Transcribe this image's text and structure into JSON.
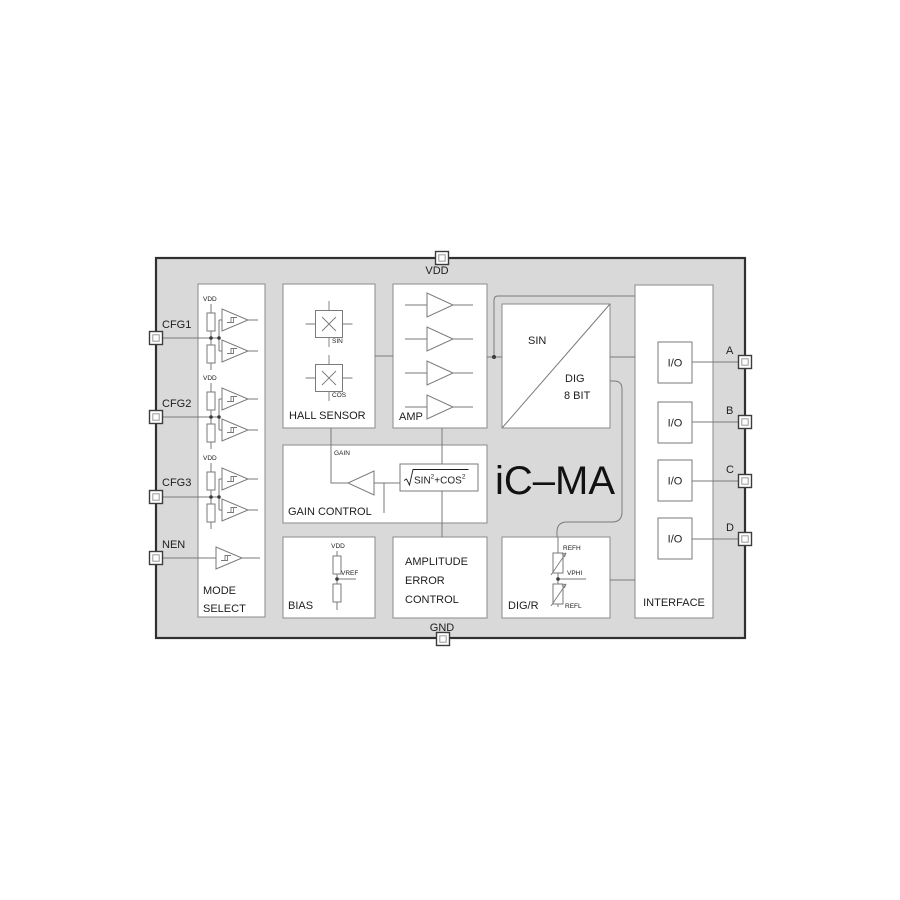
{
  "diagram": {
    "title": "iC–MA",
    "pins": {
      "top": "VDD",
      "bottom": "GND",
      "left": [
        "CFG1",
        "CFG2",
        "CFG3",
        "NEN"
      ],
      "right": [
        "A",
        "B",
        "C",
        "D"
      ]
    },
    "blocks": {
      "mode_select": {
        "label1": "MODE",
        "label2": "SELECT",
        "vdd": "VDD"
      },
      "hall_sensor": {
        "label": "HALL SENSOR",
        "sin": "SIN",
        "cos": "COS"
      },
      "amp": {
        "label": "AMP"
      },
      "adc": {
        "sin": "SIN",
        "dig": "DIG",
        "bits": "8 BIT"
      },
      "gain_control": {
        "label": "GAIN CONTROL",
        "gain": "GAIN",
        "formula_p1": "SIN",
        "formula_sup1": "2",
        "formula_p2": "+COS",
        "formula_sup2": "2"
      },
      "bias": {
        "label": "BIAS",
        "vdd": "VDD",
        "vref": "VREF"
      },
      "amplitude_error_control": {
        "label1": "AMPLITUDE",
        "label2": "ERROR",
        "label3": "CONTROL"
      },
      "dig_r": {
        "label": "DIG/R",
        "refh": "REFH",
        "vphi": "VPHI",
        "refl": "REFL"
      },
      "interface": {
        "label": "INTERFACE",
        "io": "I/O"
      }
    },
    "colors": {
      "chip_fill": "#d9d9d9",
      "chip_border": "#303030",
      "block_fill": "#ffffff",
      "block_stroke": "#8a8a8a",
      "wire": "#7a7a7a",
      "text": "#1d1d1d"
    }
  }
}
